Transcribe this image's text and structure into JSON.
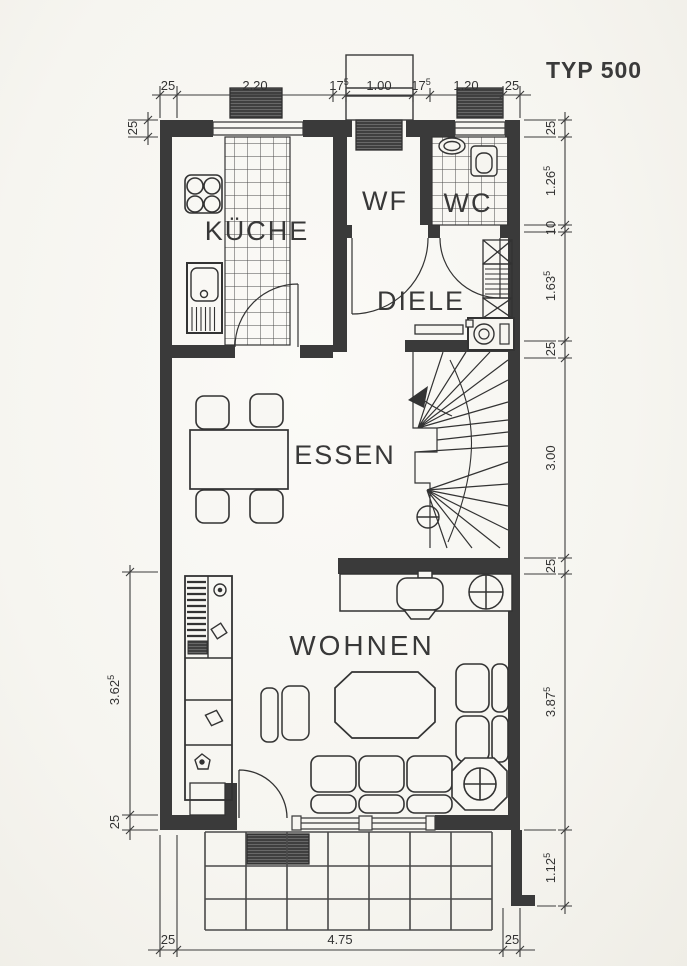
{
  "title": "TYP 500",
  "rooms": {
    "kueche": "KÜCHE",
    "wf": "WF",
    "wc": "WC",
    "diele": "DIELE",
    "essen": "ESSEN",
    "wohnen": "WOHNEN"
  },
  "dims": {
    "top": [
      {
        "v": "25"
      },
      {
        "v": "2.20"
      },
      {
        "v": "17",
        "s": "5"
      },
      {
        "v": "1.00"
      },
      {
        "v": "17",
        "s": "5"
      },
      {
        "v": "1.20"
      },
      {
        "v": "25"
      }
    ],
    "right": [
      {
        "v": "25"
      },
      {
        "v": "1.26",
        "s": "5"
      },
      {
        "v": "10"
      },
      {
        "v": "1.63",
        "s": "5"
      },
      {
        "v": "25"
      },
      {
        "v": "3.00"
      },
      {
        "v": "25"
      },
      {
        "v": "3.87",
        "s": "5"
      },
      {
        "v": "1.12",
        "s": "5"
      }
    ],
    "left": [
      {
        "v": "25"
      },
      {
        "v": "3.62",
        "s": "5"
      },
      {
        "v": "25"
      }
    ],
    "bottom": [
      {
        "v": "25"
      },
      {
        "v": "4.75"
      },
      {
        "v": "25"
      }
    ]
  },
  "colors": {
    "ink": "#333333",
    "wall": "#3a3a3a",
    "paper": "#f6f5f0"
  }
}
